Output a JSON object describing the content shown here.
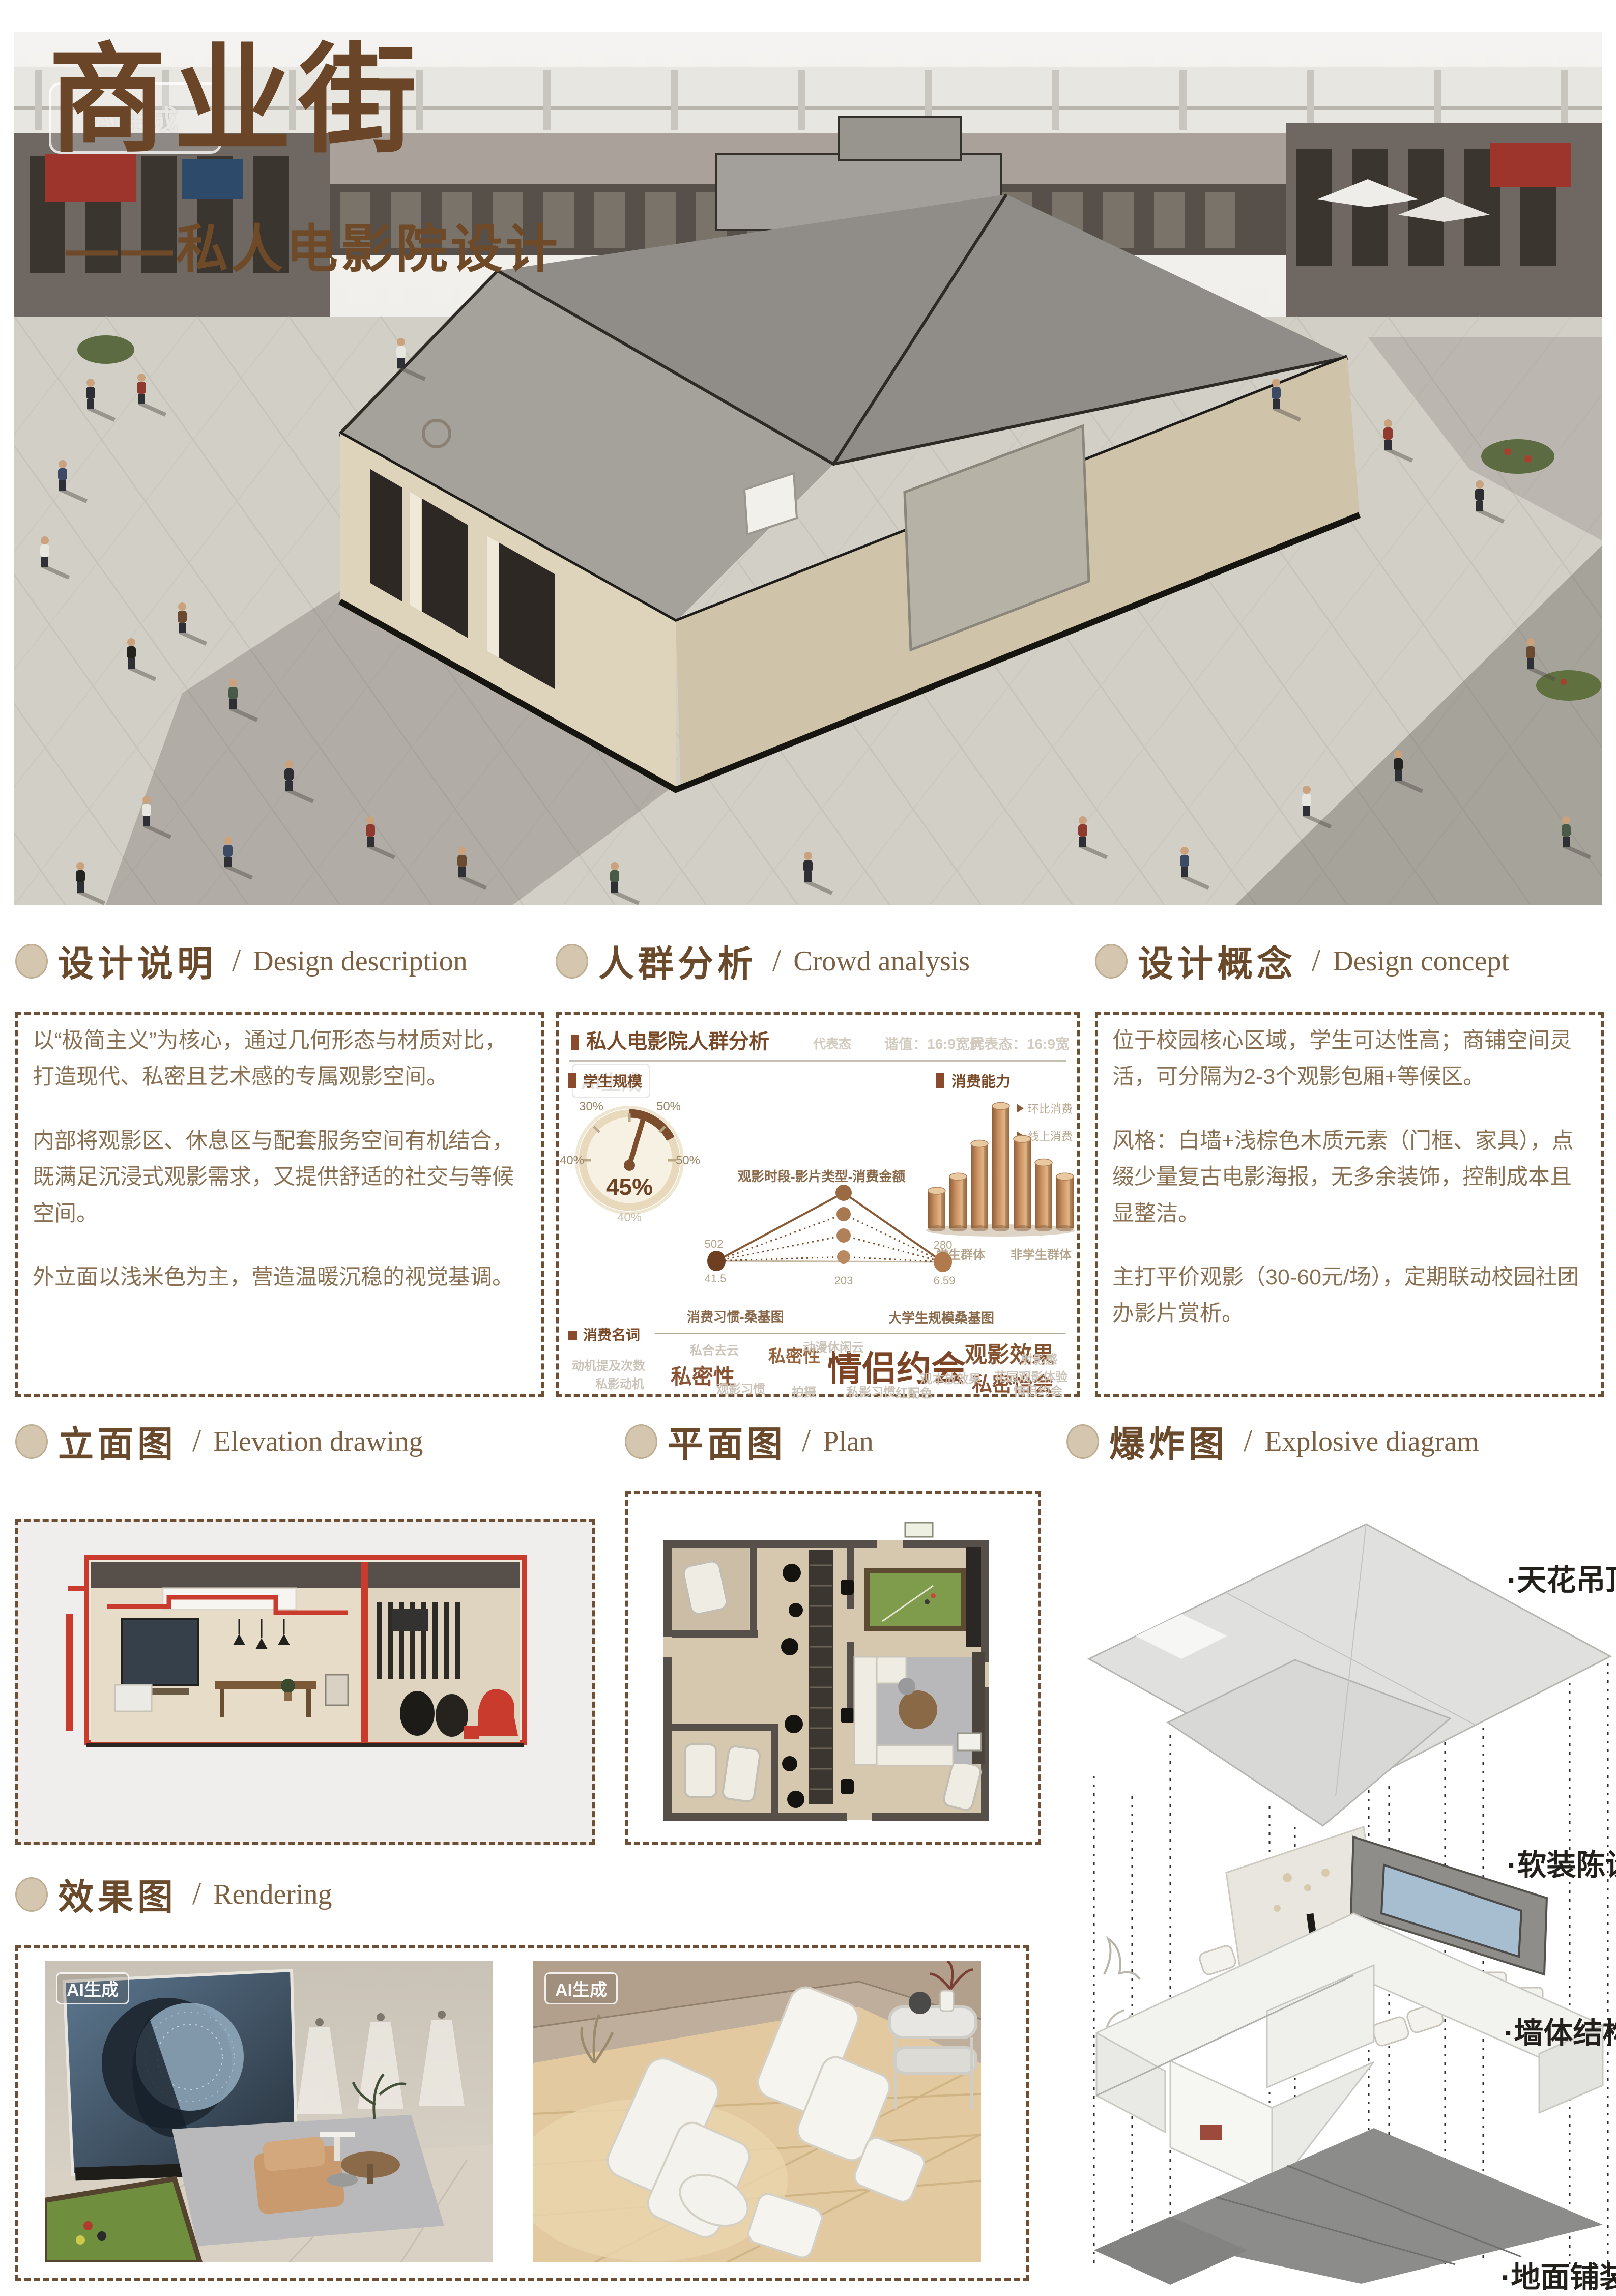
{
  "ui": {
    "slash": "/"
  },
  "hero": {
    "watermark": "AI生成",
    "title": "商业街",
    "subtitle": "——私人电影院设计"
  },
  "sections": {
    "design_description": {
      "zh": "设计说明",
      "en": "Design description",
      "paragraphs": [
        "以“极简主义”为核心，通过几何形态与材质对比，打造现代、私密且艺术感的专属观影空间。",
        "内部将观影区、休息区与配套服务空间有机结合，既满足沉浸式观影需求，又提供舒适的社交与等候空间。",
        "外立面以浅米色为主，营造温暖沉稳的视觉基调。"
      ]
    },
    "crowd_analysis": {
      "zh": "人群分析",
      "en": "Crowd analysis"
    },
    "design_concept": {
      "zh": "设计概念",
      "en": "Design concept",
      "paragraphs": [
        "位于校园核心区域，学生可达性高；商铺空间灵活，可分隔为2-3个观影包厢+等候区。",
        "风格：白墙+浅棕色木质元素（门框、家具），点缀少量复古电影海报，无多余装饰，控制成本且显整洁。",
        "主打平价观影（30-60元/场），定期联动校园社团办影片赏析。"
      ]
    },
    "elevation": {
      "zh": "立面图",
      "en": "Elevation drawing"
    },
    "plan": {
      "zh": "平面图",
      "en": "Plan"
    },
    "explosive": {
      "zh": "爆炸图",
      "en": "Explosive diagram",
      "labels": [
        "·天花吊顶",
        "·软装陈设",
        "·墙体结构",
        "·地面铺装"
      ]
    },
    "rendering": {
      "zh": "效果图",
      "en": "Rendering",
      "badge": "AI生成"
    }
  },
  "infographic": {
    "title": "私人电影院人群分析",
    "watermark": "AI生成",
    "meta_left": "代表态",
    "meta_mid": "谐值：16:9宽屏",
    "meta_right": "代表态：16:9宽",
    "gauge_label": "学生规模",
    "gauge_value": "45%",
    "gauge_ticks": [
      "30%",
      "50%",
      "40%",
      "50%",
      "40%"
    ],
    "bars_label": "消费能力",
    "legend": [
      "环比消费",
      "线上消费"
    ],
    "bar_axis": [
      "学生群体",
      "非学生群体"
    ],
    "funnel_title": "观影时段-影片类型-消费金额",
    "node_values": [
      "502",
      "203",
      "280",
      "41.5",
      "6.59"
    ],
    "sankey_left": "消费习惯-桑基图",
    "sankey_right": "大学生规模桑基图",
    "wordcloud_label": "消费名词"
  },
  "wordcloud": {
    "main": [
      "私密性",
      "私密性",
      "情侣约会",
      "观影效果",
      "私密怡会"
    ],
    "faint": [
      "动机提及次数",
      "私影动机",
      "私合去云",
      "观影习惯",
      "拍摄",
      "动漫休闲云",
      "私影习惯",
      "红配色",
      "观本放效果",
      "射影感",
      "花园观影体验",
      "情侣约会"
    ]
  },
  "chart_data": [
    {
      "type": "pie",
      "subtype": "gauge",
      "title": "学生规模",
      "value_pct": 45,
      "tick_labels_pct": [
        30,
        40,
        40,
        50,
        50
      ],
      "unit": "%",
      "note": "表盘指针指向45%"
    },
    {
      "type": "bar",
      "title": "消费能力",
      "categories": [
        "学生群体",
        "非学生群体"
      ],
      "values": [
        40,
        55,
        90,
        130,
        95,
        70,
        55
      ],
      "ylim": [
        0,
        130
      ],
      "note": "7根铜色3D圆柱，中部最高，数值为相对高度估值",
      "legend": [
        "环比消费",
        "线上消费"
      ],
      "legend_position": "right"
    },
    {
      "type": "scatter",
      "subtype": "radial-links",
      "title": "观影时段-影片类型-消费金额",
      "series": [
        {
          "name": "节点标注值",
          "values": [
            502,
            203,
            280,
            41.5,
            6.59
          ]
        }
      ],
      "note": "虚线放射连线：左节点“消费习惯-桑基图”，右节点“大学生规模桑基图”"
    },
    {
      "type": "table",
      "subtype": "wordcloud",
      "title": "消费名词",
      "categories": [
        "情侣约会",
        "私密性",
        "观影效果",
        "私密怡会",
        "观影习惯",
        "动机提及次数",
        "私影动机",
        "动漫休闲云",
        "私影习惯",
        "花园观影体验"
      ],
      "values": [
        5,
        4,
        3,
        3,
        1,
        1,
        1,
        1,
        1,
        1
      ],
      "note": "数值为相对字号权重"
    }
  ]
}
